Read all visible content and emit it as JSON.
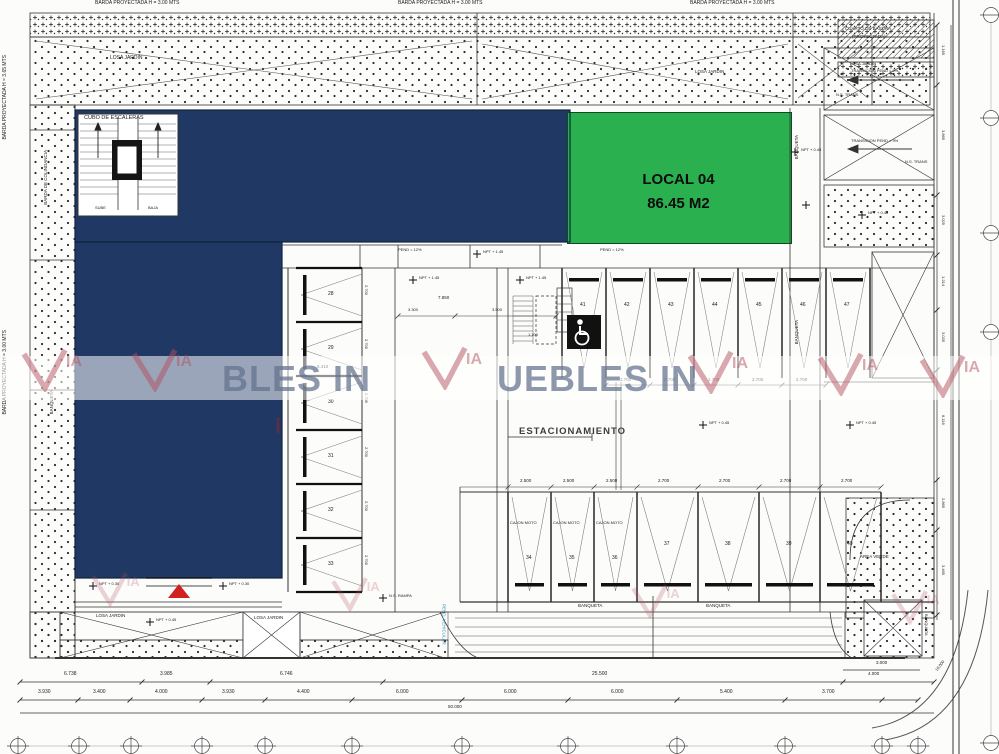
{
  "colors": {
    "navy": "#1f3864",
    "green": "#2ab04f",
    "accent_red": "#d02020",
    "via_red": "#b4505e",
    "watermark_text": "#68779b",
    "line": "#2f2f2f",
    "teal": "#2c93a8"
  },
  "perimeter": {
    "barda_top_left": "BARDA PROYECTADA H = 3.00 MTS",
    "barda_top_center": "BARDA PROYECTADA H = 3.00 MTS",
    "barda_top_right": "BARDA PROYECTADA H = 3.00 MTS",
    "barda_left_upper": "BARDA PROYECTADA H = 3.65 MTS",
    "barda_left_lower": "BARDA PROYECTADA H = 3.00 MTS",
    "colindancia": "BARDA DE COLINDANCIA",
    "banqueta": "BANQUETA"
  },
  "building": {
    "cubo_label": "CUBO DE ESCALERAS",
    "sube": "SUBE",
    "baja": "BAJA"
  },
  "local": {
    "name": "LOCAL 04",
    "area": "86.45 M2"
  },
  "parking": {
    "label": "ESTACIONAMIENTO",
    "left_stalls": [
      "28",
      "29",
      "30",
      "31",
      "32",
      "33"
    ],
    "top_stalls": [
      "41",
      "42",
      "43",
      "44",
      "45",
      "46",
      "47"
    ],
    "bottom_stalls": [
      "34",
      "35",
      "36",
      "37",
      "38",
      "39",
      "40"
    ],
    "moto_label": "CAJON MOTO",
    "dim_2700": "2.700",
    "dim_2500": "2.500",
    "left_dim": "5.410"
  },
  "ramps": {
    "transicion": "TRANSICION PEND = 9%",
    "pend12": "PEND = 12%",
    "ns_trans": "N.S. TRANS",
    "ns_rampa": "N.S. RAMPA",
    "basura_line1": "CUARTO DE BASURA",
    "basura_line2": "(PROYECTADA)",
    "pend_vehicular": "PEND. VEHICULAR",
    "rampa": "RAMPA"
  },
  "areas": {
    "losa_jardin": "LOSA JARDIN",
    "area_verde": "AREA VERDE"
  },
  "npt": {
    "v145": "NPT + 1.45",
    "v045": "NPT + 0.45",
    "v030": "NPT + 0.30"
  },
  "dims": {
    "upper_chain": [
      "6.738",
      "3.985",
      "6.746",
      "25.500"
    ],
    "right_upper": [
      "3.000",
      "4.000"
    ],
    "lower_chain": [
      "3.930",
      "3.400",
      "4.000",
      "3.930",
      "4.400",
      "6.000",
      "6.000",
      "6.000",
      "5.400",
      "3.700"
    ],
    "total": "50.000",
    "right_chain": [
      "1.165",
      "3.865",
      "3.025",
      "1.214",
      "3.035",
      "6.116",
      "2.865",
      "3.465"
    ],
    "inner_a": "7.850",
    "inner_b": "3.300",
    "inner_c": "3.500",
    "inner_d": "1.100",
    "corner": "10.000"
  },
  "watermark": {
    "frag_left": "BLES IN",
    "frag_right": "UEBLES IN",
    "ia": "IA"
  }
}
